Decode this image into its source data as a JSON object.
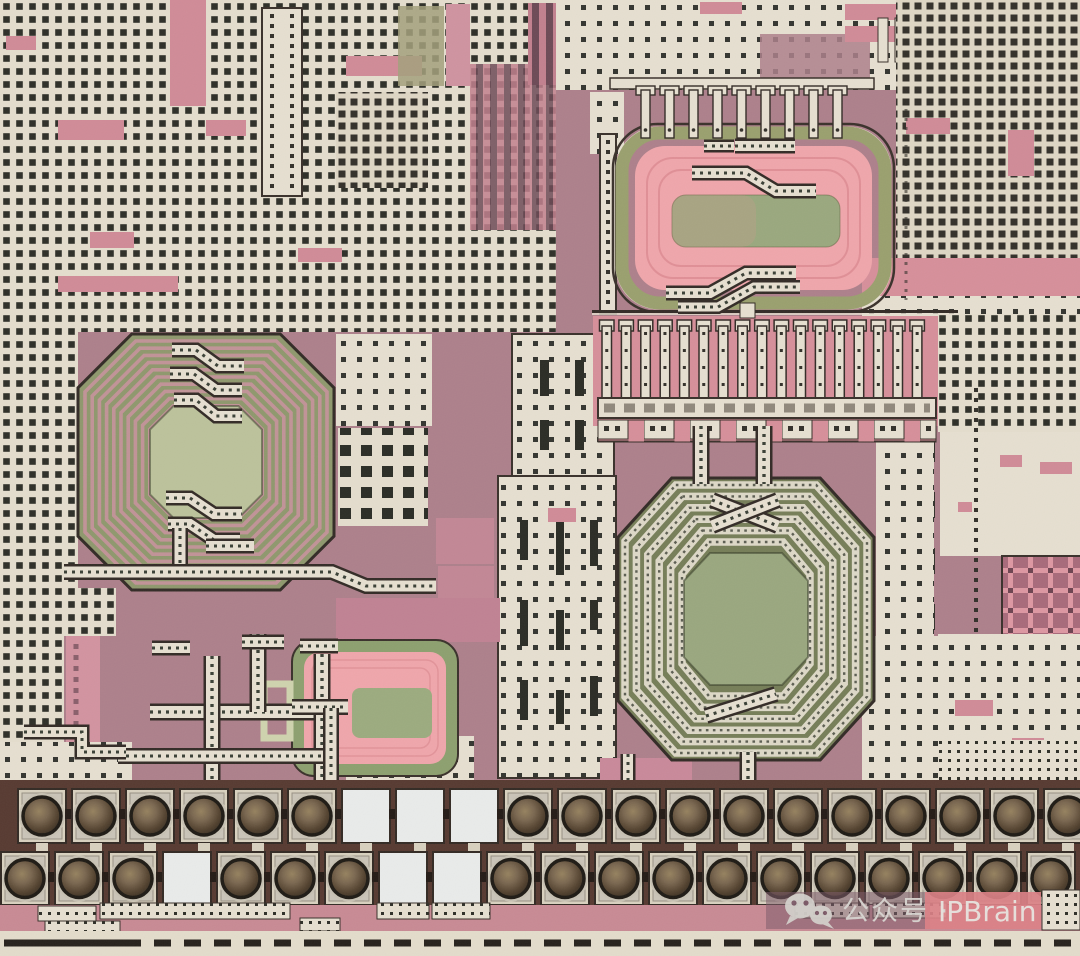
{
  "meta": {
    "description": "Photomicrograph of an integrated circuit die: octagonal spiral inductors, dummy metal fill patterns, MOM capacitor combs and two staggered rows of bond pads with probe-marked balls along the bottom edge",
    "alt_text": "IC die photo"
  },
  "watermark": {
    "icon_name": "wechat-icon",
    "text": "公众号 · IPBrain",
    "text_left": "公众号 ·",
    "text_right": "IPBrain"
  },
  "colors": {
    "bg": "#ad808b",
    "metal": "#e6dfd0",
    "metal_bright": "#e9ebea",
    "hole": "#2e2f28",
    "outline": "#3a312b",
    "pink": "#d08b97",
    "pink_band": "#d68f9a",
    "ind_pink": "#efa6ab",
    "ring_pink": "#c5939b",
    "olive": "#9aa06e",
    "sage": "#9aa87e",
    "left_field": "#8f986d",
    "left_center": "#bcc29b",
    "big_field": "#767e58",
    "big_center": "#9aa77f",
    "pad_band": "#573a31",
    "cream_band": "#e3dccb",
    "dash": "#27221c",
    "wm_text": "#d9d6d1",
    "wm_pink": "#db8086",
    "wm_bar": "#7d5b69"
  },
  "die": {
    "inductors": [
      {
        "id": "left",
        "shape": "octagon-spiral",
        "cx": 206,
        "cy": 462,
        "rx": 128,
        "ry": 128,
        "field": "left_field",
        "rings": {
          "count": 10,
          "r0": 121,
          "pitch": 7.2,
          "width": 3.6,
          "color": "ring_pink",
          "dotted": false
        },
        "center": {
          "r": 56,
          "fill": "left_center"
        }
      },
      {
        "id": "center-right",
        "shape": "octagon-spiral",
        "cx": 746,
        "cy": 619,
        "rx": 128,
        "ry": 141,
        "field": "big_field",
        "rings": {
          "count": 6,
          "r0": 121,
          "ry0": 134,
          "pitch": 11.4,
          "width": 7.5,
          "color": "metal",
          "dotted": true
        },
        "center": {
          "r": 62,
          "ry": 66,
          "fill": "big_center"
        }
      },
      {
        "id": "top-right",
        "shape": "stadium-spiral",
        "note": "rendered statically"
      },
      {
        "id": "small-bottom",
        "shape": "rounded-rect-spiral",
        "note": "rendered statically"
      }
    ],
    "comb": {
      "count": 17,
      "x0": 602,
      "pitch": 19.4,
      "width": 9.5,
      "y": 326,
      "height": 74
    },
    "stubs": {
      "count": 9,
      "x0": 641,
      "pitch": 24,
      "y": 90,
      "stem_w": 9,
      "stem_h": 48
    },
    "pads": {
      "pad_w": 48,
      "ball_r": 19,
      "rows": [
        {
          "y": 789,
          "h": 54,
          "start": 42,
          "pitch": 54,
          "count": 20,
          "empty": [
            6,
            7,
            8
          ]
        },
        {
          "y": 852,
          "h": 53,
          "start": 25,
          "pitch": 54,
          "count": 20,
          "empty": [
            3,
            7,
            8
          ]
        }
      ]
    }
  }
}
